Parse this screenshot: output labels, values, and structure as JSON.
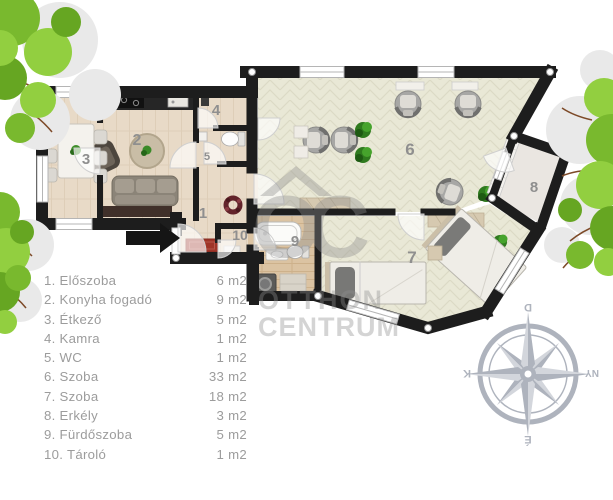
{
  "legend": {
    "items": [
      {
        "label": "1. Előszoba",
        "area": "6 m2"
      },
      {
        "label": "2. Konyha fogadó",
        "area": "9 m2"
      },
      {
        "label": "3. Étkező",
        "area": "5 m2"
      },
      {
        "label": "4. Kamra",
        "area": "1 m2"
      },
      {
        "label": "5. WC",
        "area": "1 m2"
      },
      {
        "label": "6. Szoba",
        "area": "33 m2"
      },
      {
        "label": "7. Szoba",
        "area": "18 m2"
      },
      {
        "label": "8. Erkély",
        "area": "3 m2"
      },
      {
        "label": "9. Fürdőszoba",
        "area": "5 m2"
      },
      {
        "label": "10. Tároló",
        "area": "1 m2"
      }
    ]
  },
  "plan": {
    "rooms": [
      {
        "label": "1"
      },
      {
        "label": "2"
      },
      {
        "label": "3"
      },
      {
        "label": "4"
      },
      {
        "label": "5"
      },
      {
        "label": "6"
      },
      {
        "label": "7"
      },
      {
        "label": "8"
      },
      {
        "label": "9"
      },
      {
        "label": "10"
      }
    ]
  },
  "watermark": {
    "monogram": "OC",
    "line1": "OTTHON",
    "line2": "CENTRUM"
  },
  "compass": {
    "top": "D",
    "right": "NY",
    "bottom": "É",
    "left": "K"
  },
  "colors": {
    "wall": "#1d1d1d",
    "floor_warm": "#e8dac7",
    "floor_sage": "#e9e8d6",
    "floor_wood_bath": "#dbc3a2",
    "balcony_floor": "#eae6e1",
    "mat_red": "#9f3428",
    "legend_text": "#9c9c9c",
    "room_label": "#8f8f8f",
    "compass": "#aeb3bd",
    "tree_dark": "#66a622",
    "tree_mid": "#79b92e",
    "tree_light": "#92cf40",
    "watermark": "#8f8f8f"
  }
}
